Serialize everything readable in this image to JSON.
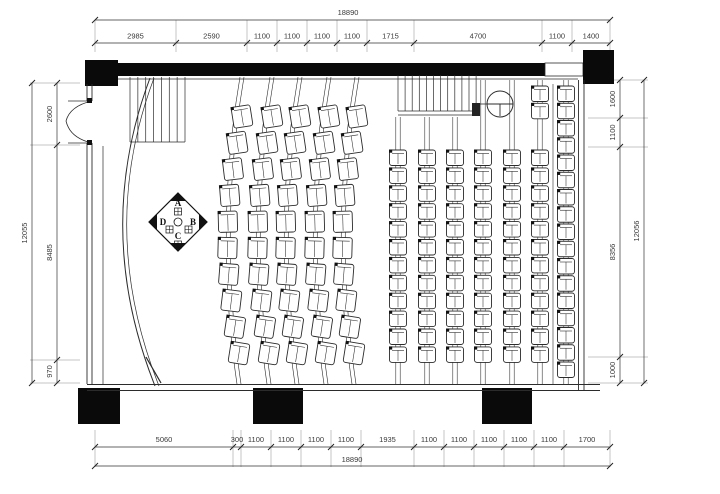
{
  "dims": {
    "top_overall": "18890",
    "top_segments": [
      "2985",
      "2590",
      "1100",
      "1100",
      "1100",
      "1100",
      "1715",
      "4700",
      "1100",
      "1400"
    ],
    "bottom_segments": [
      "5060",
      "300",
      "1100",
      "1100",
      "1100",
      "1100",
      "1935",
      "1100",
      "1100",
      "1100",
      "1100",
      "1100",
      "1700"
    ],
    "bottom_overall": "18890",
    "left_overall": "12055",
    "left_segments": [
      "2600",
      "8485",
      "970"
    ],
    "right_overall": "12056",
    "right_segments": [
      "1600",
      "1100",
      "8356",
      "1000"
    ]
  },
  "emblem": {
    "letters": [
      "A",
      "B",
      "C",
      "D"
    ]
  },
  "seating": {
    "curved_columns": 5,
    "curved_seats_per_column": 10,
    "straight_columns": 6,
    "straight_seats_per_column": 12,
    "wall_column_seats": 17,
    "entry_pair_seats": 2
  },
  "colors": {
    "wall": "#0a0a0a",
    "line": "#2b2b2b",
    "dim_text": "#3a3a3a",
    "ext_line": "#8a8a8a"
  }
}
